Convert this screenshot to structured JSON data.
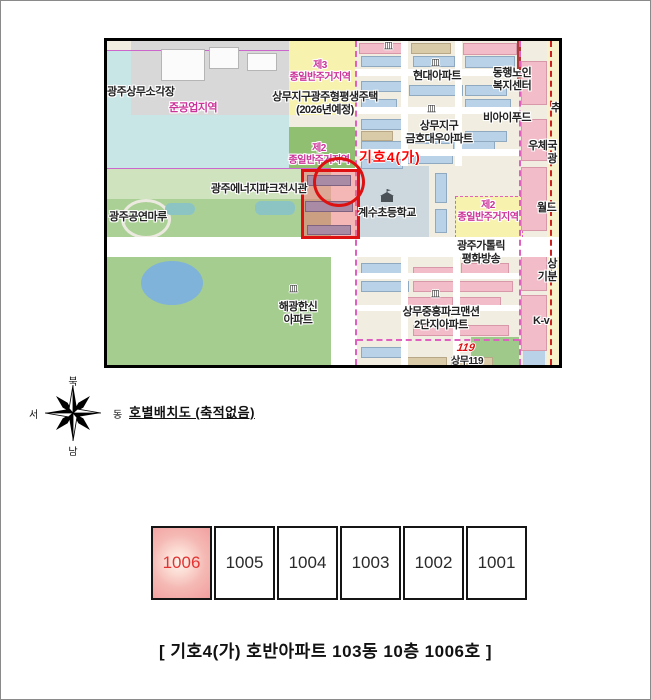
{
  "document": {
    "layout_title": "호별배치도 (축적없음)",
    "caption": "[  기호4(가) 호반아파트 103동 10층 1006호   ]"
  },
  "compass": {
    "north": "북",
    "south": "남",
    "east": "동",
    "west": "서"
  },
  "map": {
    "highlight_label": "기호4(가)",
    "labels": [
      {
        "id": "label-incinerator",
        "text": "광주상무소각장",
        "x": 0,
        "y": 45
      },
      {
        "id": "label-semi-industrial-zone",
        "text": "준공업지역",
        "x": 62,
        "y": 61,
        "color": "#cc3399"
      },
      {
        "id": "label-zone3-residential",
        "text": "제3\n종일반주거지역",
        "x": 176,
        "y": 19,
        "color": "#cc3399",
        "size": 10,
        "align": "center",
        "w": 74
      },
      {
        "id": "label-sangmu-housing-2026",
        "text": "상무지구광주형평생주택\n(2026년예정)",
        "x": 146,
        "y": 50,
        "align": "center",
        "w": 144
      },
      {
        "id": "label-hyundai-apt",
        "text": "현대아파트",
        "x": 294,
        "y": 29,
        "align": "center",
        "w": 72
      },
      {
        "id": "label-donghaeng-welfare",
        "text": "동행노인\n복지센터",
        "x": 372,
        "y": 26,
        "align": "center",
        "w": 66
      },
      {
        "id": "label-kumho-daewoo-apt",
        "text": "상무지구\n금호대우아파트",
        "x": 286,
        "y": 79,
        "align": "center",
        "w": 92
      },
      {
        "id": "label-bi-food",
        "text": "비아이푸드",
        "x": 364,
        "y": 71,
        "align": "center",
        "w": 72
      },
      {
        "id": "label-zone2-residential-left",
        "text": "제2\n종일반주거지역",
        "x": 175,
        "y": 102,
        "color": "#cc3399",
        "size": 10,
        "align": "center",
        "w": 74
      },
      {
        "id": "label-energy-park-hall",
        "text": "광주에너지파크전시관",
        "x": 88,
        "y": 142,
        "align": "center",
        "w": 128
      },
      {
        "id": "label-performance-maru",
        "text": "광주공연마루",
        "x": 2,
        "y": 170
      },
      {
        "id": "label-gyesu-elementary",
        "text": "계수초등학교",
        "x": 240,
        "y": 166,
        "align": "center",
        "w": 80
      },
      {
        "id": "label-zone2-residential-right",
        "text": "제2\n종일반주거지역",
        "x": 344,
        "y": 159,
        "color": "#cc3399",
        "size": 10,
        "align": "center",
        "w": 74
      },
      {
        "id": "label-catholic-broadcast",
        "text": "광주가톨릭\n평화방송",
        "x": 336,
        "y": 199,
        "align": "center",
        "w": 76
      },
      {
        "id": "label-haegwang-hanshin-apt",
        "text": "해광한신\n아파트",
        "x": 156,
        "y": 260,
        "align": "center",
        "w": 70
      },
      {
        "id": "label-jungheung-park-apt",
        "text": "상무중흥파크맨션\n2단지아파트",
        "x": 282,
        "y": 265,
        "align": "center",
        "w": 104
      },
      {
        "id": "label-post-office",
        "text": "우체국\n광",
        "x": 420,
        "y": 99,
        "align": "right",
        "w": 30
      },
      {
        "id": "label-partial-world",
        "text": "월드",
        "x": 430,
        "y": 161
      },
      {
        "id": "label-partial-sang",
        "text": "상\n기분",
        "x": 424,
        "y": 217,
        "align": "right",
        "w": 26
      },
      {
        "id": "label-partial-kv",
        "text": "K-v",
        "x": 426,
        "y": 274
      },
      {
        "id": "label-partial-chu",
        "text": "추",
        "x": 444,
        "y": 61
      },
      {
        "id": "label-sangmu-119",
        "text": "상무119",
        "x": 344,
        "y": 315,
        "size": 10
      }
    ],
    "icons": [
      {
        "name": "building-icon",
        "glyph": "皿",
        "x": 324,
        "y": 18
      },
      {
        "name": "building-icon",
        "glyph": "皿",
        "x": 320,
        "y": 64
      },
      {
        "name": "building-icon",
        "glyph": "皿",
        "x": 277,
        "y": 1
      },
      {
        "name": "building-icon",
        "glyph": "皿",
        "x": 182,
        "y": 244
      },
      {
        "name": "building-icon",
        "glyph": "皿",
        "x": 324,
        "y": 249
      },
      {
        "name": "fire-119-icon",
        "glyph": "119",
        "x": 350,
        "y": 302,
        "cls": "i119"
      }
    ]
  },
  "units": {
    "cells": [
      {
        "label": "1006",
        "highlighted": true
      },
      {
        "label": "1005",
        "highlighted": false
      },
      {
        "label": "1004",
        "highlighted": false
      },
      {
        "label": "1003",
        "highlighted": false
      },
      {
        "label": "1002",
        "highlighted": false
      },
      {
        "label": "1001",
        "highlighted": false
      }
    ]
  },
  "colors": {
    "highlight_red": "#dd1111",
    "marker_text": "#ff0000",
    "zone_label": "#cc3399",
    "unit_highlight_bg": "#f1a0a0",
    "unit_highlight_text": "#e23333"
  }
}
